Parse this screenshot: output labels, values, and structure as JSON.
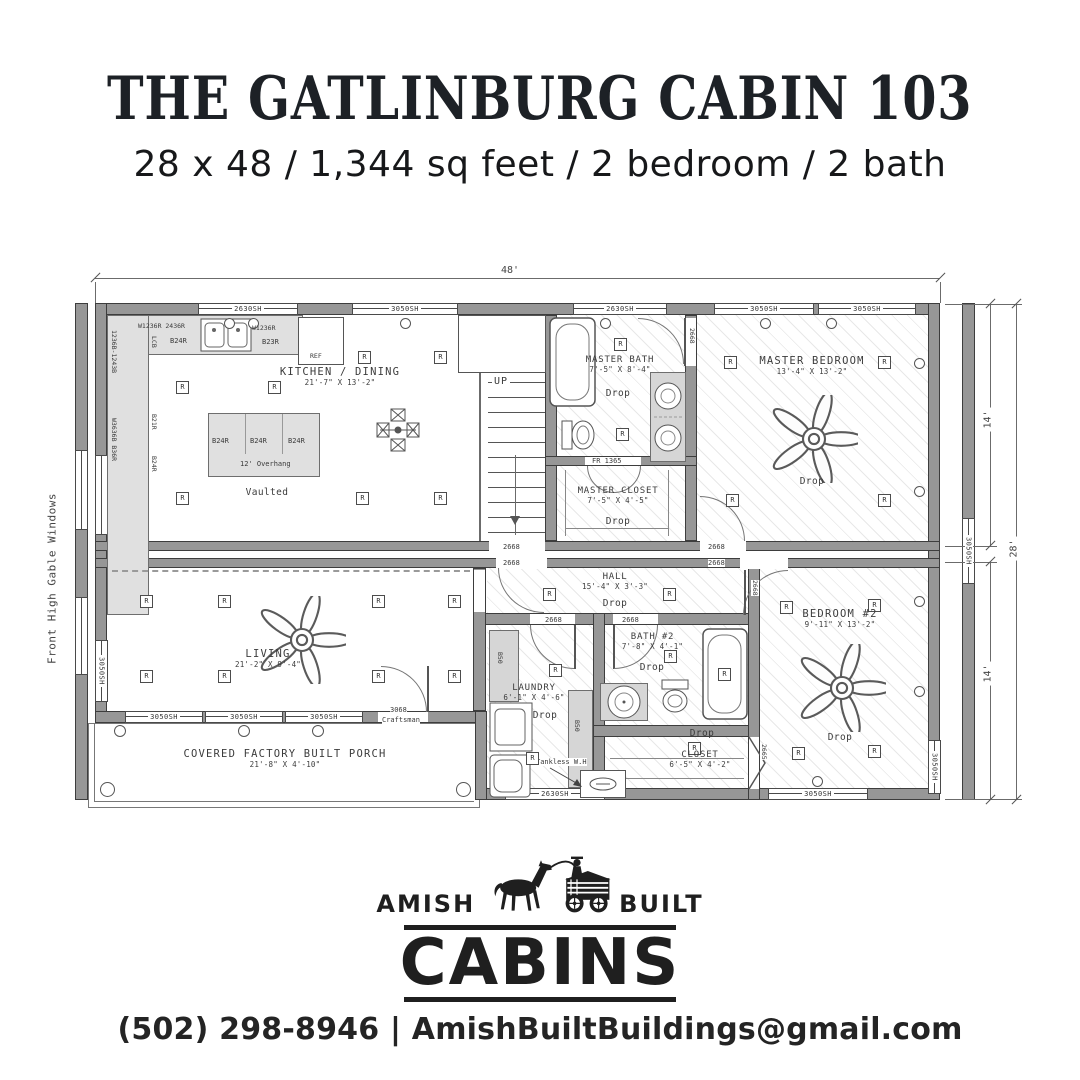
{
  "header": {
    "title": "THE GATLINBURG CABIN 103",
    "subtitle": "28 x 48 / 1,344 sq feet / 2 bedroom / 2 bath"
  },
  "plan": {
    "dims": {
      "width": "48'",
      "total": "28'",
      "half_top": "14'",
      "half_bottom": "14'"
    },
    "labels": {
      "gable_note": "Front High Gable Windows",
      "up": "UP",
      "tankless": "Tankless W.H",
      "ref": "REF",
      "overhang": "12' Overhang"
    },
    "symbols": {
      "recessed": "R"
    },
    "windows": {
      "sh2630": "2630SH",
      "sh3050": "3050SH"
    },
    "doors": {
      "code2668": "2668",
      "code2665": "2665",
      "front_code": "3068",
      "front_type": "Craftsman",
      "framed_opening": "FR 1365"
    },
    "cabinets": {
      "b24r": "B24R",
      "b23r": "B23R",
      "b21r": "B21R",
      "lcb": "LCB",
      "b50": "B50",
      "wa": "W1236R 2436R",
      "wb": "W1236R",
      "wc": "1236B-1243B",
      "wd": "W3636B B36R"
    },
    "rooms": {
      "kitchen": {
        "name": "KITCHEN / DINING",
        "size": "21'-7\" X 13'-2\"",
        "ceiling": "Vaulted"
      },
      "master_bath": {
        "name": "MASTER BATH",
        "size": "7'-5\" X 8'-4\"",
        "ceiling": "Drop"
      },
      "master_closet": {
        "name": "MASTER CLOSET",
        "size": "7'-5\" X 4'-5\"",
        "ceiling": "Drop"
      },
      "master_bedroom": {
        "name": "MASTER BEDROOM",
        "size": "13'-4\" X 13'-2\"",
        "ceiling": "Drop"
      },
      "hall": {
        "name": "HALL",
        "size": "15'-4\" X 3'-3\"",
        "ceiling": "Drop"
      },
      "living": {
        "name": "LIVING",
        "size": "21'-2\" X 9'-4\""
      },
      "laundry": {
        "name": "LAUNDRY",
        "size": "6'-1\" X 4'-6\"",
        "ceiling": "Drop"
      },
      "bath2": {
        "name": "BATH #2",
        "size": "7'-8\" X 4'-1\"",
        "ceiling": "Drop"
      },
      "closet2": {
        "name": "CLOSET",
        "size": "6'-5\" X 4'-2\"",
        "ceiling": "Drop"
      },
      "bedroom2": {
        "name": "BEDROOM #2",
        "size": "9'-11\" X 13'-2\"",
        "ceiling": "Drop"
      },
      "porch": {
        "name": "COVERED FACTORY BUILT PORCH",
        "size": "21'-8\" X 4'-10\""
      }
    }
  },
  "logo": {
    "amish": "AMISH",
    "built": "BUILT",
    "cabins": "CABINS"
  },
  "contact": {
    "phone": "(502) 298-8946",
    "separator": "|",
    "email": "AmishBuiltBuildings@gmail.com"
  }
}
